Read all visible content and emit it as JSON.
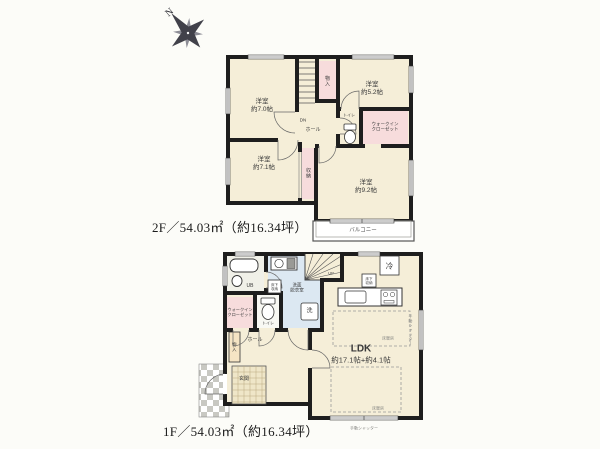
{
  "colors": {
    "wall": "#1e1e1e",
    "room_floor": "#f5eed8",
    "closet_pink": "#f7dcdc",
    "washroom_blue": "#dce8f2",
    "bath_gray": "#f0f0e8",
    "closet_tan": "#f5e4c4",
    "entrance_tile": "#efe6c8",
    "porch_checker": "#c8c8c2"
  },
  "compass": {
    "n": "N"
  },
  "floor2": {
    "area_label": "2F／54.03㎡（約16.34坪）",
    "bedroom_nw": {
      "l1": "洋室",
      "l2": "約7.0帖"
    },
    "bedroom_ne": {
      "l1": "洋室",
      "l2": "約5.2帖"
    },
    "bedroom_w": {
      "l1": "洋室",
      "l2": "約7.1帖"
    },
    "bedroom_se": {
      "l1": "洋室",
      "l2": "約9.2帖"
    },
    "wic": {
      "l1": "ウォークイン",
      "l2": "クローゼット"
    },
    "toilet": "トイレ",
    "hall": "ホール",
    "dn": "DN",
    "closet_top": "物入",
    "closet_mid": "収納",
    "balcony": "バルコニー"
  },
  "floor1": {
    "area_label": "1F／54.03㎡（約16.34坪）",
    "ldk": {
      "l1": "LDK",
      "l2": "約17.1帖+約4.1帖"
    },
    "washroom": {
      "l1": "洗面",
      "l2": "脱衣室"
    },
    "bath": "UB",
    "wic": {
      "l1": "ウォークイン",
      "l2": "クローゼット"
    },
    "toilet": "トイレ",
    "hall": "ホール",
    "entrance": "玄関",
    "closet": "物入",
    "up": "UP",
    "fridge": "冷",
    "washer": "洗",
    "underfloor_wash": {
      "l1": "床下",
      "l2": "収納"
    },
    "underfloor_kitchen": {
      "l1": "床下",
      "l2": "収納"
    },
    "floor_heating_1": "床暖房",
    "floor_heating_2": "床暖房",
    "shutter_right": "手動シャッター",
    "shutter_bottom": "手動シャッター"
  }
}
